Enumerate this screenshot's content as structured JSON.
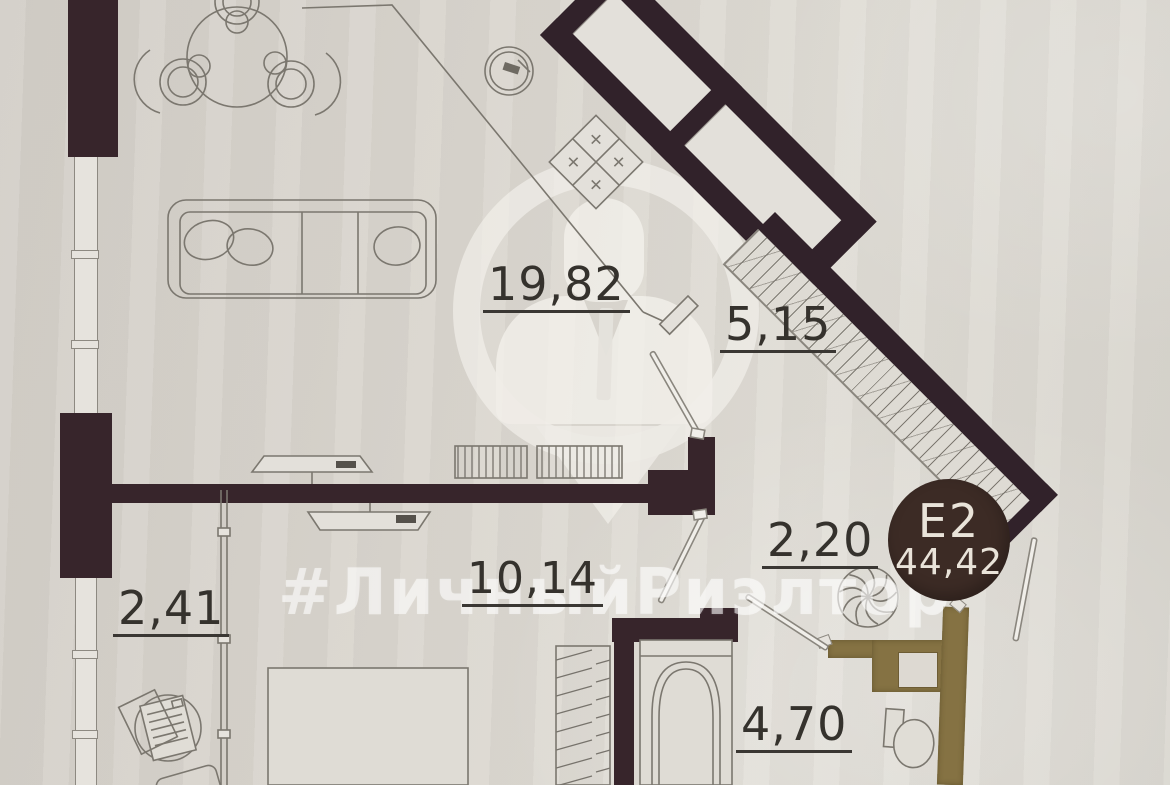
{
  "document": {
    "kind": "apartment floor plan photo",
    "unit_badge": {
      "unit": "E2",
      "total_area": "44,42"
    },
    "watermark": {
      "hashtag": "#ЛичныйРиэлтор"
    }
  },
  "rooms": {
    "living_kitchen": {
      "area": "19,82"
    },
    "loggia_diagonal": {
      "area": "5,15"
    },
    "hallway": {
      "area": "2,20"
    },
    "balcony_left": {
      "area": "2,41"
    },
    "bedroom": {
      "area": "10,14"
    },
    "bathroom": {
      "area": "4,70"
    }
  },
  "colors": {
    "paper": "#d9d5ce",
    "wall_dark": "#37252b",
    "wall_gold": "#857243",
    "badge_bg": "#3c2b25",
    "badge_text": "#e9e3d9",
    "label_text": "#35322d",
    "furniture_line": "#7b776f",
    "watermark": "rgba(255,255,255,0.55)"
  },
  "icons": [
    "dining-table-icon",
    "chair-icon",
    "sofa-icon",
    "tv-icon",
    "shelving-icon",
    "kitchen-sink-icon",
    "stove-icon",
    "bed-icon",
    "wardrobe-icon",
    "bathtub-icon",
    "toilet-icon",
    "ventilation-fan-icon",
    "radiator-icon",
    "door-leaf-icon",
    "realtor-pin-watermark-icon"
  ]
}
